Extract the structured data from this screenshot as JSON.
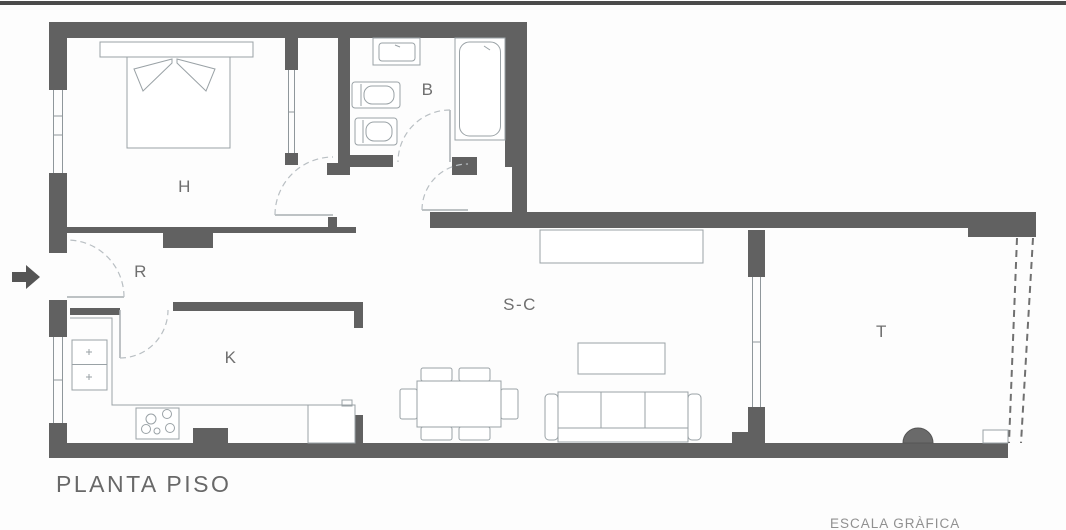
{
  "title": "PLANTA PISO",
  "scale_caption": "ESCALA GRÀFICA",
  "rooms": {
    "bedroom": {
      "label": "H"
    },
    "bathroom": {
      "label": "B"
    },
    "hall": {
      "label": "R"
    },
    "kitchen": {
      "label": "K"
    },
    "living_dining": {
      "label": "S-C"
    },
    "terrace": {
      "label": "T"
    }
  },
  "icons": {
    "entry_arrow": "right-arrow"
  },
  "colors": {
    "wall": "#616161",
    "furniture_line": "#9aa2a6",
    "room_label_text": "#6f6f6f",
    "title_text": "#686868",
    "background": "#fdfdfd"
  }
}
